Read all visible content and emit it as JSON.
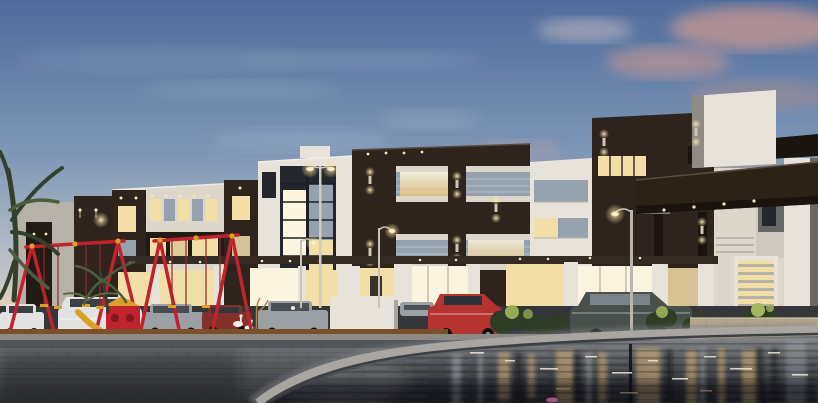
{
  "scene": {
    "alt": "Dusk architectural rendering of a modern residential complex: dark-brown and white villas with lit windows, an entrance canopy, parked cars, a red playground swing set, palm trees, a paved plaza and a reflecting pool in the foreground",
    "time_of_day": "dusk",
    "objects": [
      "sky",
      "clouds",
      "apartment-buildings",
      "entrance-canopy",
      "street-lamps",
      "parked-cars",
      "playground-swings",
      "palm-trees",
      "shrubs",
      "ducks",
      "plaza-pavers",
      "pool-coping",
      "reflecting-pool"
    ]
  },
  "palette": {
    "sky_top": "#4e6c9d",
    "sky_mid": "#7e96b6",
    "sky_low": "#b3bcc6",
    "sky_horizon": "#e7d9c8",
    "cloud_pink": "#c39793",
    "cloud_light": "#d6c6c2",
    "cloud_wisp": "#a9bacc",
    "facade_dark": "#2e241d",
    "facade_darker": "#221a14",
    "facade_white": "#e8e3da",
    "facade_cream": "#ddd6cb",
    "facade_gray": "#b6b1a9",
    "window_lit": "#f2dfa8",
    "window_bright": "#fbf4df",
    "glass_dusk": "#95a2ae",
    "glass_dark": "#23262c",
    "canopy_dark": "#2c2218",
    "canopy_deep": "#1a130e",
    "coping": "#a9a6a1",
    "stone": "#b3a68c",
    "plaza_light": "#6a6d71",
    "plaza_dark": "#2c2e32",
    "road": "#53555a",
    "curb": "#8e8b85",
    "timber": "#7c4f2b",
    "water_top": "#85878a",
    "water_mid": "#4a4d52",
    "water_deep": "#1b1d21",
    "refl_warm": "#d9b478",
    "refl_gray": "#aab0b5",
    "sparkle": "#f0e8d6",
    "lamp_glow": "#f5dfa0",
    "play_red": "#c2222b",
    "play_yellow": "#d9a125",
    "palm": "#33402c",
    "palm_light": "#4d5c3e",
    "shrub": "#2f3d27",
    "shrub_lit": "#a3b75c",
    "car_white": "#e2e2e2",
    "car_silver": "#9aa0a6",
    "car_red": "#b53430",
    "car_darkred": "#82302a",
    "car_gray": "#9aa0a4",
    "car_darksedan": "#49504b",
    "duck": "#f2f0ea",
    "accent_pink": "#c75f96"
  }
}
